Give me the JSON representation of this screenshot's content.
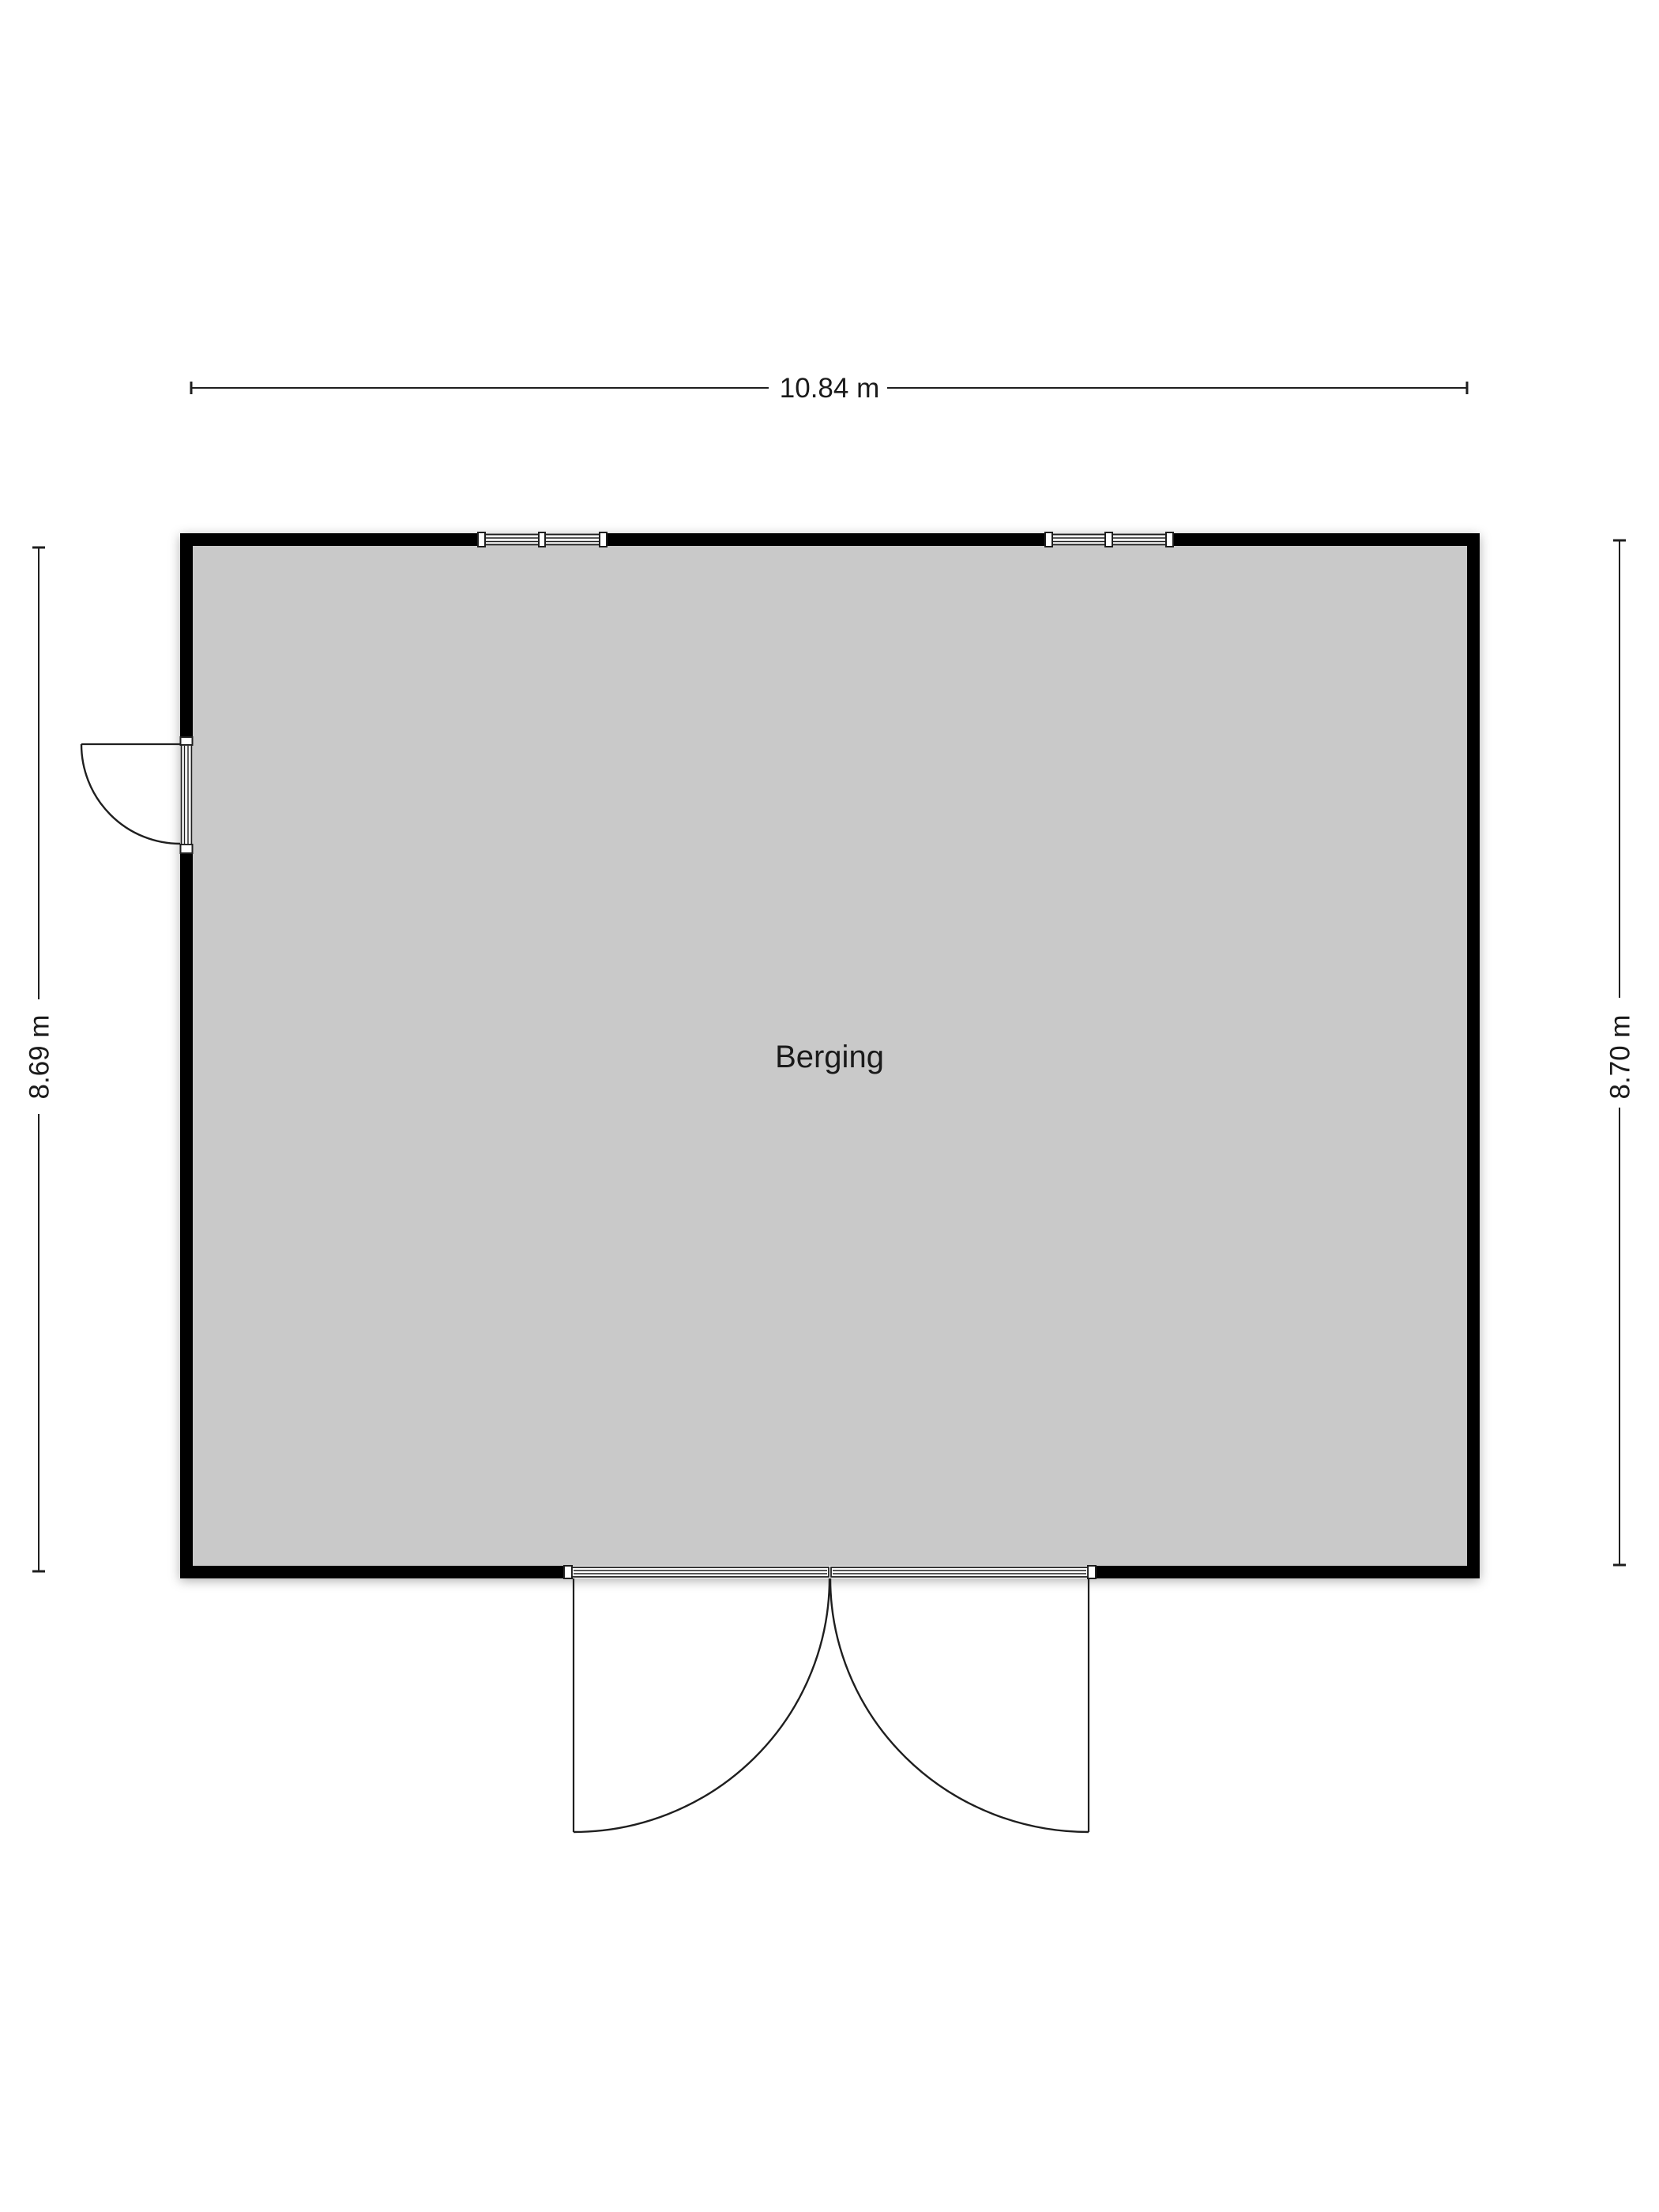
{
  "page": {
    "background_color": "#ffffff"
  },
  "plan": {
    "room_label": "Berging",
    "dimensions": {
      "top": "10.84 m",
      "left": "8.69 m",
      "right": "8.70 m"
    },
    "features": {
      "windows": [
        "double-window-north-west",
        "double-window-north-east"
      ],
      "doors": [
        "single-swing-door-west",
        "double-swing-door-south"
      ]
    },
    "colors": {
      "floor": "#c9c9c9",
      "wall": "#000000",
      "line": "#1f1f1f",
      "text": "#1a1a1a"
    }
  }
}
